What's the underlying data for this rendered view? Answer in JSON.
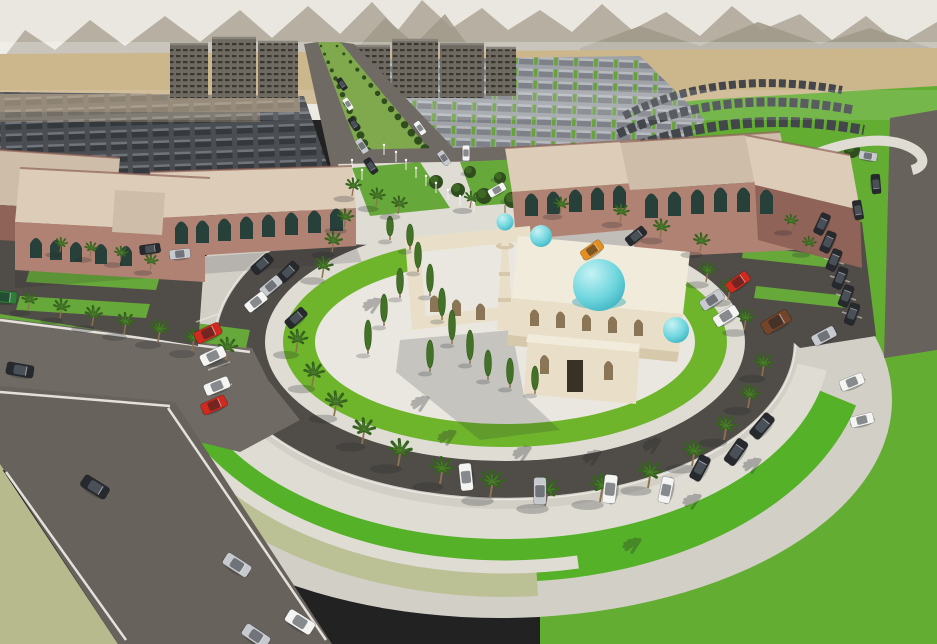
{
  "meta": {
    "description": "Aerial 3D architectural rendering of a desert master-plan community: a cream mosque with turquoise domes and a minaret stands on a white circular plaza encircled by a ring road with palm trees and parked cars; two terracotta civic buildings flank the plaza; rows of townhouses, a green tree-lined boulevard and apartment blocks stretch to hazy mountains on the horizon.",
    "view": "aerial-perspective",
    "style": "photorealistic-render"
  },
  "palette": {
    "sky": "#e9e7e0",
    "mountain": "#b6afa2",
    "mountain2": "#a19a8a",
    "desert": "#ccb68c",
    "blur_band": "#c7ab82",
    "haze": "#ffffff",
    "field": "#63ad33",
    "grass_bright": "#55b128",
    "grass_ring": "#6fb52c",
    "grass_olive": "#b7ba8d",
    "verge": "#bcc095",
    "lawn": "#67a83a",
    "concrete": "#d2cfc7",
    "plaza": "#eae7e0",
    "walk": "#dfdcd4",
    "asphalt": "#504c47",
    "road": "#6f6a64",
    "street": "#67625c",
    "line": "#f2f0ea",
    "boulevard_green": "#7fa94c",
    "tree": "#2f4d1d",
    "tree_hi": "#4a7d2a",
    "cypress": "#447128",
    "palm_leaf": "#36621f",
    "palm_leaf2": "#4a7d2a",
    "palm_trunk": "#8b7352",
    "mosque_wall": "#e9dfc8",
    "mosque_shade": "#d6c8aa",
    "mosque_roof": "#f1ebdb",
    "mosque_dark": "#a08c66",
    "arch_niche": "#8a7556",
    "door_dark": "#3a3126",
    "dome": "#6fd6de",
    "dome_deep": "#2ea8b8",
    "bldg_wall": "#b08273",
    "bldg_shade": "#8f6357",
    "bldg_roof": "#dcccb8",
    "bldg_roof2": "#cebda8",
    "bldg_arch": "#27403a",
    "housing_dark": "#43464b",
    "shadow": "#23282c",
    "car_colors": {
      "white": "#f4f4f2",
      "silver": "#c6c9cd",
      "black": "#26292d",
      "red": "#cf2a1d",
      "orange": "#e58f1f",
      "brown": "#74452a",
      "green": "#2f7d3a"
    }
  },
  "objects": {
    "landmark": "mosque-with-turquoise-domes",
    "dome_count": 4,
    "minaret_count": 1,
    "cars": [
      [
        95,
        487,
        32,
        "black",
        1.1
      ],
      [
        237,
        565,
        33,
        "silver",
        1.1
      ],
      [
        300,
        622,
        32,
        "white",
        1.15
      ],
      [
        256,
        636,
        34,
        "silver",
        1.1
      ],
      [
        20,
        370,
        10,
        "black",
        1.05
      ],
      [
        4,
        297,
        5,
        "green",
        1
      ],
      [
        208,
        333,
        -25,
        "red",
        1.05
      ],
      [
        213,
        356,
        -25,
        "white",
        1
      ],
      [
        217,
        386,
        -22,
        "white",
        1
      ],
      [
        214,
        405,
        -24,
        "red",
        1
      ],
      [
        262,
        264,
        -42,
        "black",
        0.9
      ],
      [
        288,
        272,
        -44,
        "black",
        0.9
      ],
      [
        271,
        286,
        -40,
        "silver",
        0.9
      ],
      [
        256,
        302,
        -38,
        "white",
        0.9
      ],
      [
        296,
        318,
        -42,
        "black",
        0.9
      ],
      [
        150,
        249,
        -8,
        "black",
        0.8
      ],
      [
        180,
        254,
        -6,
        "silver",
        0.8
      ],
      [
        466,
        477,
        -96,
        "white",
        1.05
      ],
      [
        540,
        491,
        -90,
        "silver",
        1.05
      ],
      [
        610,
        489,
        -84,
        "white",
        1.1
      ],
      [
        666,
        490,
        -78,
        "white",
        1
      ],
      [
        736,
        452,
        -55,
        "black",
        1.05
      ],
      [
        762,
        426,
        -50,
        "black",
        1.05
      ],
      [
        700,
        468,
        -62,
        "black",
        1
      ],
      [
        592,
        250,
        -35,
        "orange",
        0.9
      ],
      [
        636,
        236,
        -38,
        "black",
        0.85
      ],
      [
        738,
        282,
        -35,
        "red",
        0.95
      ],
      [
        776,
        322,
        -30,
        "brown",
        1.15
      ],
      [
        726,
        316,
        -32,
        "white",
        1
      ],
      [
        712,
        300,
        -33,
        "silver",
        0.95
      ],
      [
        824,
        336,
        -28,
        "silver",
        0.95
      ],
      [
        852,
        382,
        -22,
        "white",
        0.95
      ],
      [
        862,
        420,
        -14,
        "white",
        0.9
      ],
      [
        822,
        224,
        -65,
        "black",
        0.85
      ],
      [
        828,
        242,
        -66,
        "black",
        0.85
      ],
      [
        834,
        260,
        -67,
        "black",
        0.85
      ],
      [
        840,
        278,
        -68,
        "black",
        0.85
      ],
      [
        846,
        296,
        -69,
        "black",
        0.85
      ],
      [
        852,
        314,
        -70,
        "black",
        0.85
      ],
      [
        868,
        156,
        10,
        "silver",
        0.7
      ],
      [
        876,
        184,
        85,
        "black",
        0.75
      ],
      [
        858,
        210,
        80,
        "black",
        0.75
      ],
      [
        342,
        84,
        57,
        "black",
        0.5
      ],
      [
        348,
        104,
        57,
        "white",
        0.5
      ],
      [
        354,
        124,
        57,
        "black",
        0.55
      ],
      [
        362,
        146,
        57,
        "silver",
        0.6
      ],
      [
        371,
        166,
        57,
        "black",
        0.65
      ],
      [
        420,
        128,
        55,
        "white",
        0.55
      ],
      [
        444,
        158,
        55,
        "silver",
        0.6
      ],
      [
        466,
        153,
        90,
        "white",
        0.6
      ],
      [
        497,
        190,
        -30,
        "white",
        0.7
      ]
    ],
    "palms": [
      [
        28,
        310,
        0.8
      ],
      [
        60,
        318,
        0.85
      ],
      [
        92,
        326,
        0.9
      ],
      [
        124,
        334,
        0.95
      ],
      [
        158,
        342,
        1
      ],
      [
        192,
        351,
        1
      ],
      [
        226,
        360,
        1
      ],
      [
        120,
        262,
        0.7
      ],
      [
        150,
        270,
        0.7
      ],
      [
        60,
        252,
        0.65
      ],
      [
        90,
        257,
        0.68
      ],
      [
        296,
        352,
        1
      ],
      [
        312,
        386,
        1.05
      ],
      [
        334,
        416,
        1.1
      ],
      [
        362,
        444,
        1.15
      ],
      [
        398,
        466,
        1.2
      ],
      [
        440,
        484,
        1.2
      ],
      [
        490,
        498,
        1.25
      ],
      [
        545,
        506,
        1.25
      ],
      [
        600,
        502,
        1.25
      ],
      [
        648,
        488,
        1.2
      ],
      [
        692,
        466,
        1.15
      ],
      [
        724,
        440,
        1.1
      ],
      [
        748,
        408,
        1.05
      ],
      [
        762,
        376,
        1
      ],
      [
        706,
        282,
        0.9
      ],
      [
        728,
        300,
        0.95
      ],
      [
        744,
        330,
        0.95
      ],
      [
        700,
        252,
        0.85
      ],
      [
        352,
        196,
        0.8
      ],
      [
        376,
        206,
        0.8
      ],
      [
        398,
        214,
        0.8
      ],
      [
        344,
        228,
        0.85
      ],
      [
        332,
        252,
        0.9
      ],
      [
        322,
        278,
        0.95
      ],
      [
        470,
        208,
        0.75
      ],
      [
        560,
        214,
        0.75
      ],
      [
        620,
        222,
        0.8
      ],
      [
        660,
        238,
        0.85
      ],
      [
        790,
        230,
        0.7
      ],
      [
        808,
        252,
        0.7
      ]
    ],
    "cypresses": [
      [
        418,
        272,
        26
      ],
      [
        430,
        296,
        28
      ],
      [
        442,
        320,
        28
      ],
      [
        400,
        298,
        26
      ],
      [
        384,
        326,
        28
      ],
      [
        368,
        354,
        30
      ],
      [
        452,
        344,
        30
      ],
      [
        470,
        364,
        30
      ],
      [
        430,
        372,
        28
      ],
      [
        488,
        380,
        26
      ],
      [
        510,
        388,
        26
      ],
      [
        535,
        394,
        24
      ],
      [
        410,
        250,
        22
      ],
      [
        390,
        240,
        20
      ]
    ],
    "round_trees": [
      [
        436,
        182,
        7
      ],
      [
        458,
        190,
        7
      ],
      [
        484,
        196,
        8
      ],
      [
        512,
        200,
        8
      ],
      [
        536,
        206,
        8
      ],
      [
        470,
        172,
        6
      ],
      [
        500,
        178,
        6
      ],
      [
        852,
        150,
        8
      ],
      [
        836,
        196,
        6
      ]
    ],
    "light_poles": [
      [
        396,
        162
      ],
      [
        406,
        170
      ],
      [
        416,
        178
      ],
      [
        426,
        186
      ],
      [
        436,
        193
      ],
      [
        448,
        200
      ],
      [
        384,
        155
      ],
      [
        460,
        206
      ],
      [
        474,
        212
      ],
      [
        352,
        170
      ],
      [
        362,
        180
      ]
    ],
    "palm_shadows": [
      [
        455,
        432
      ],
      [
        530,
        448
      ],
      [
        600,
        452
      ],
      [
        660,
        440
      ],
      [
        700,
        496
      ],
      [
        640,
        540
      ],
      [
        428,
        398
      ],
      [
        380,
        300
      ],
      [
        760,
        460
      ]
    ],
    "median_tree_rows": [
      {
        "x1": 321,
        "y1": 46,
        "x2": 382,
        "y2": 184,
        "n": 18
      },
      {
        "x1": 337,
        "y1": 46,
        "x2": 452,
        "y2": 180,
        "n": 18
      }
    ]
  }
}
